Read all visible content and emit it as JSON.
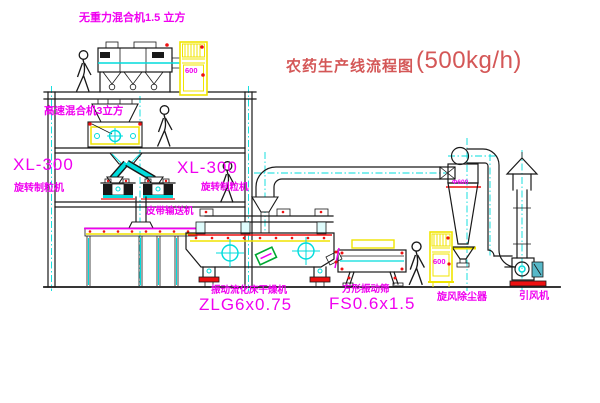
{
  "title": {
    "name": "农药生产线流程图",
    "capacity": "(500kg/h)"
  },
  "equipment": {
    "gravity_mixer": {
      "label": "无重力混合机1.5 立方"
    },
    "high_speed_mixer": {
      "label": "高速混合机3立方"
    },
    "granulator_left": {
      "model": "XL-300",
      "label": "旋转制粒机"
    },
    "granulator_right": {
      "model": "XL-300",
      "label": "旋转制粒机"
    },
    "belt_conveyor": {
      "label": "皮带输送机"
    },
    "fluid_bed_dryer": {
      "label": "振动流化床干燥机",
      "model": "ZLG6x0.75"
    },
    "vibrating_screen": {
      "label": "方形振动筛",
      "model": "FS0.6x1.5"
    },
    "cyclone": {
      "label": "旋风除尘器",
      "size": "Φ600"
    },
    "fan": {
      "label": "引风机"
    },
    "cabinet_top": {
      "text": "600"
    },
    "cabinet_right": {
      "text": "600"
    }
  },
  "colors": {
    "magenta": "#f000f0",
    "title_red": "#d45757",
    "red": "#ee1111",
    "yellow": "#f0e400",
    "cyan": "#00dcdc",
    "green": "#00a832",
    "ink": "#191919"
  }
}
